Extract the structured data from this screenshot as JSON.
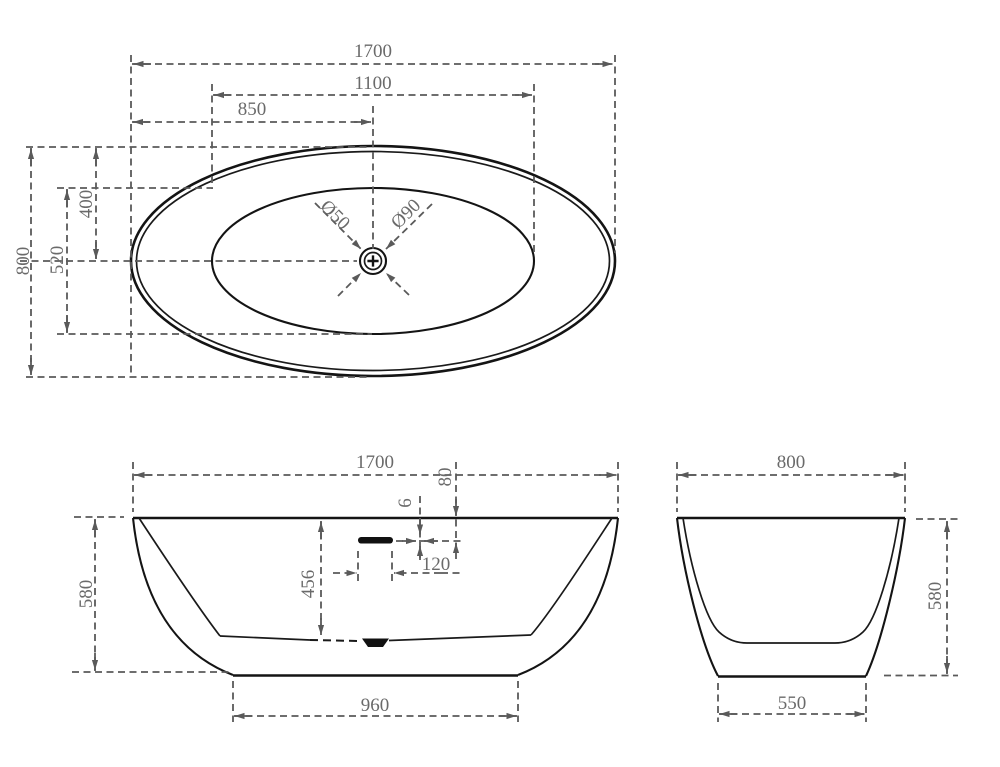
{
  "document": {
    "background": "#ffffff"
  },
  "colors": {
    "outline": "#141414",
    "dimension_lines": "#5a5a5a",
    "dimension_text": "#6a6a6a"
  },
  "views": {
    "top": {
      "title": "top-view",
      "dims": {
        "overall_length": "1700",
        "inner_length": "1100",
        "drain_from_left": "850",
        "overall_width": "800",
        "inner_width": "520",
        "drain_from_top": "400",
        "drain_diameter": "Ø50",
        "waste_diameter": "Ø90"
      }
    },
    "front": {
      "title": "front-view",
      "dims": {
        "overall_length": "1700",
        "overflow_drop": "80",
        "overflow_slot_height": "6",
        "overflow_width": "120",
        "inner_depth": "456",
        "overall_height": "580",
        "base_length": "960"
      }
    },
    "side": {
      "title": "side-view",
      "dims": {
        "overall_width": "800",
        "overall_height": "580",
        "base_width": "550"
      }
    }
  }
}
